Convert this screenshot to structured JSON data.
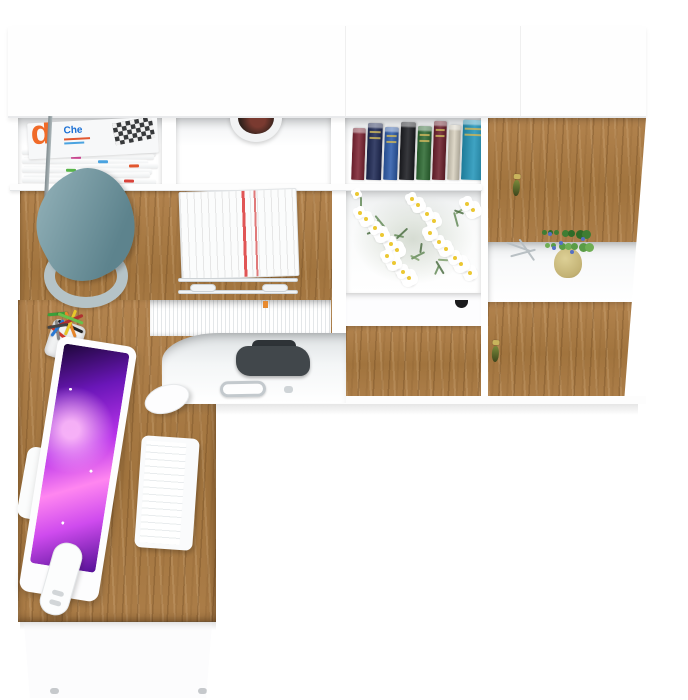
{
  "scene": {
    "description": "Top-down product render of a white and oak home office set: L-shaped computer desk with monitor, keyboard and mouse, plus a wall storage unit with shelves, drawers and keyed doors",
    "floor_color": "#ffffff",
    "furniture_white": "#fefefe",
    "wood_color": "#a97c49"
  },
  "magazines": {
    "top_letter": "d",
    "top_word": "Che",
    "letter_color": "#f06a28",
    "word_color": "#1a6fd4",
    "edge_colors": [
      "#e8d23a",
      "#d94f9c",
      "#4aa3e0",
      "#e2572f",
      "#58b54a",
      "#8a62c9",
      "#d9423a"
    ]
  },
  "books": {
    "items": [
      {
        "color": "#7e2433",
        "width": 13,
        "band": false
      },
      {
        "color": "#1f2a56",
        "width": 15,
        "band": true
      },
      {
        "color": "#2d5cab",
        "width": 14,
        "band": true
      },
      {
        "color": "#1c1d22",
        "width": 15,
        "band": false
      },
      {
        "color": "#2e6b33",
        "width": 14,
        "band": true
      },
      {
        "color": "#6d1f2c",
        "width": 13,
        "band": true
      },
      {
        "color": "#d9d2c0",
        "width": 12,
        "band": false
      },
      {
        "color": "#2496ba",
        "width": 24,
        "band": true
      }
    ]
  },
  "file_tabs": {
    "colors": [
      "#e8b43a",
      "#d94f9c",
      "#8a62c9",
      "#4aa3e0",
      "#e2572f",
      "#58b54a",
      "#e8d23a",
      "#3a66c9",
      "#d9423a",
      "#58c4b0",
      "#e88a2f"
    ]
  },
  "pens": {
    "colors": [
      "#3aa03a",
      "#222222",
      "#d43a2a",
      "#e8862a",
      "#888888",
      "#e8c82a",
      "#2a7ad4",
      "#b03030",
      "#444444",
      "#6abf4a"
    ]
  },
  "daisies": {
    "count": 30,
    "petal_color": "#ffffff",
    "center_color": "#ecc832",
    "stem_colors": [
      "#5d8450",
      "#44673a",
      "#7a9c68"
    ]
  },
  "plant": {
    "pot_color": "#c3b274",
    "leaf_colors": [
      "#3f7d33",
      "#5a9c46",
      "#2f6b28",
      "#6fae54"
    ],
    "flower_color": "#5570c4"
  },
  "lamp": {
    "shade_dark": "#5d838d",
    "shade_light": "#97b5bc",
    "base_color": "#b5c3c7"
  },
  "monitor": {
    "screen_colors": [
      "#1d0738",
      "#6a16b8",
      "#b833ea",
      "#ff86f0"
    ]
  },
  "keys": {
    "head_color": "#c9b45c",
    "tassel_color": "#5a662c",
    "count": 3
  },
  "chair": {
    "color": "#41474b"
  },
  "hardware": {
    "white_drawer_knob": "#1b1b1d",
    "metal_handle": "#c3c9cd"
  }
}
